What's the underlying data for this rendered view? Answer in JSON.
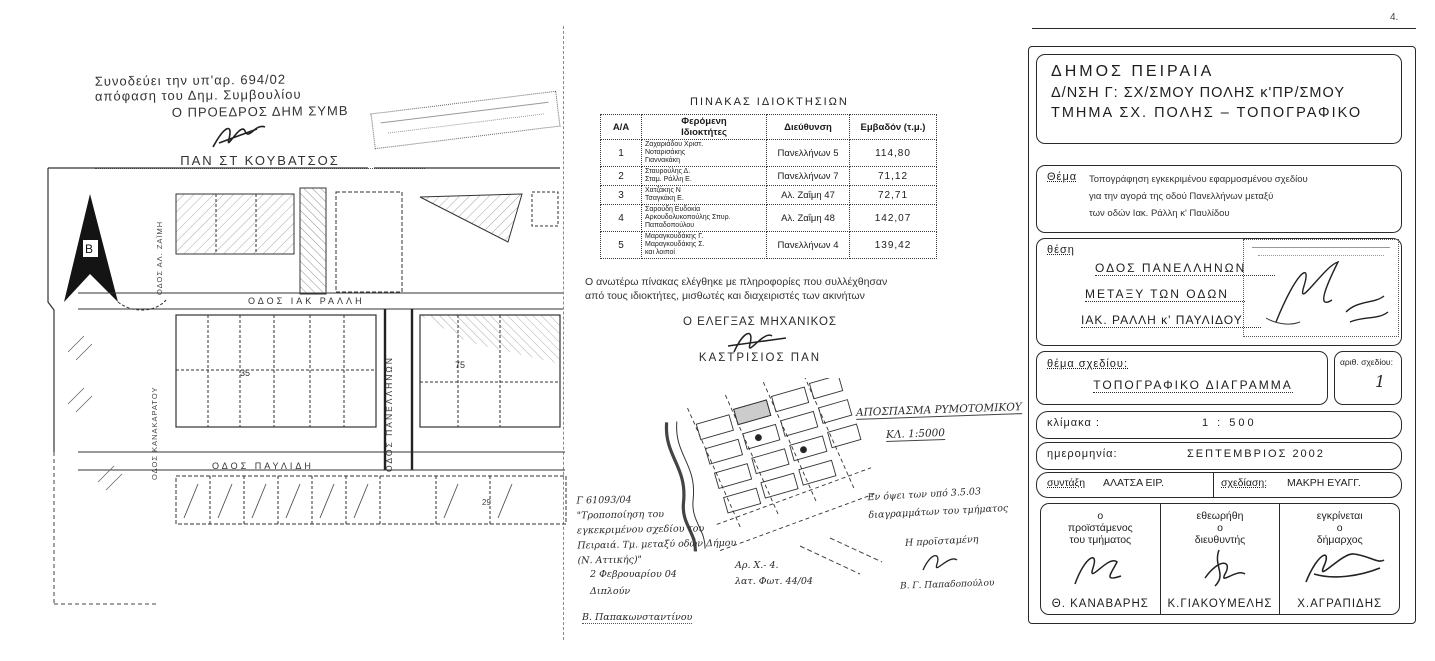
{
  "artifacts": {
    "corner_mark": "4."
  },
  "decision_stamp": {
    "line1": "Συνοδεύει  την  υπ'αρ.  694/02",
    "line2": "απόφαση  του  Δημ. Συμβουλίου",
    "line3": "Ο  ΠΡΟΕΔΡΟΣ   ΔΗΜ  ΣΥΜΒ",
    "name": "ΠΑΝ  ΣΤ  ΚΟΥΒΑΤΣΟΣ"
  },
  "plan": {
    "north_label": "Β",
    "street_ralli": "ΟΔΟΣ  ΙΑΚ  ΡΑΛΛΗ",
    "street_panellinon": "ΟΔΟΣ ΠΑΝΕΛΛΗΝΩΝ",
    "street_pavlidi": "ΟΔΟΣ ΠΑΥΛΙΔΗ",
    "street_zaimi": "ΟΔΟΣ ΑΛ. ΖΑΪΜΗ",
    "street_left": "ΟΔΟΣ ΚΑΝΑΚΑΡΑΤΟΥ",
    "lot_a": "35",
    "lot_b": "75",
    "lot_c": "29"
  },
  "ownership_table": {
    "title": "ΠΙΝΑΚΑΣ ΙΔΙΟΚΤΗΣΙΩΝ",
    "headers": {
      "index": "Α/Α",
      "owners": "Φερόμενη\nΙδιοκτήτες",
      "address": "Διεύθυνση",
      "area": "Εμβαδόν (τ.μ.)"
    },
    "rows": [
      {
        "index": "1",
        "owners": "Ζαχαριάδου Χριστ.\nΝοταρισάκης\nΓιαννακάκη",
        "address": "Πανελλήνων 5",
        "area": "114,80"
      },
      {
        "index": "2",
        "owners": "Σταυρούλης Δ.\nΣταμ. Ράλλη Ε.",
        "address": "Πανελλήνων 7",
        "area": "71,12"
      },
      {
        "index": "3",
        "owners": "Χατζάκης Ν\nΤσαγκάκη Ε.",
        "address": "Αλ. Ζαΐμη 47",
        "area": "72,71"
      },
      {
        "index": "4",
        "owners": "Σαρούδη Ευδοκία\nΑρκουδολυκοπούλης Σπυρ.\nΠαπαδοπούλου",
        "address": "Αλ. Ζαΐμη 48",
        "area": "142,07"
      },
      {
        "index": "5",
        "owners": "Μαραγκουδάκης Γ.\nΜαραγκουδάκης Σ.\nκαι λοιποί",
        "address": "Πανελλήνων 4",
        "area": "139,42"
      }
    ],
    "footnote": "Ο ανωτέρω πίνακας ελέγθηκε με πληροφορίες που συλλέχθησαν\nαπό τους ιδιοκτήτες, μισθωτές και διαχειριστές των ακινήτων"
  },
  "engineer": {
    "title": "Ο ΕΛΕΓΞΑΣ ΜΗΧΑΝΙΚΟΣ",
    "name": "ΚΑΣΤΡΙΣΙΟΣ ΠΑΝ"
  },
  "excerpt_map": {
    "caption": "ΑΠΟΣΠΑΣΜΑ ΡΥΜΟΤΟΜΙΚΟΥ",
    "scale": "ΚΛ. 1:5000"
  },
  "handwritten": {
    "left_note": "Γ 61093/04\n\"Τροποποίηση του\nεγκεκριμένου σχεδίου του\nΠειραιά. Τμ. μεταξύ οδών Δήμου\n(Ν. Αττικής)\"",
    "left_date": "2 Φεβρουαρίου 04\nΔιπλούν",
    "left_name": "Β. Παπακωνσταντίνου",
    "center_note": "Αρ. Χ.-  4.\nλατ. Φωτ.  44/04",
    "right_note": "Εν όψει των υπό 3.5.03\nδιαγραμμάτων του τμήματος",
    "right_role": "Η προϊσταμένη",
    "right_name": "Β. Γ. Παπαδοπούλου"
  },
  "titleblock": {
    "header_line1": "ΔΗΜΟΣ  ΠΕΙΡΑΙΑ",
    "header_line2": "Δ/ΝΣΗ  Γ: ΣΧ/ΣΜΟΥ  ΠΟΛΗΣ κ'ΠΡ/ΣΜΟΥ",
    "header_line3": "ΤΜΗΜΑ ΣΧ. ΠΟΛΗΣ – ΤΟΠΟΓΡΑΦΙΚΟ",
    "thema_label": "Θέμα",
    "thema_text": "Τοπογράφηση εγκεκριμένου εφαρμοσμένου σχεδίου\nγια την  αγορά  της οδού Πανελλήνων μεταξύ\nτων οδών  Ιακ. Ράλλη  κ'  Παυλίδου",
    "thesi_label": "θέση",
    "thesi_line1": "ΟΔΟΣ   ΠΑΝΕΛΛΗΝΩΝ",
    "thesi_line2": "ΜΕΤΑΞΥ  ΤΩΝ  ΟΔΩΝ",
    "thesi_line3": "ΙΑΚ. ΡΑΛΛΗ  κ'  ΠΑΥΛΙΔΟΥ",
    "drawing_label": "θέμα σχεδίου:",
    "drawing_value": "ΤΟΠΟΓΡΑΦΙΚΟ   ΔΙΑΓΡΑΜΜΑ",
    "drawing_no_label": "αριθ. σχεδίου:",
    "drawing_no_value": "1",
    "scale_label": "κλίμακα :",
    "scale_value": "1 : 500",
    "date_label": "ημερομηνία:",
    "date_value": "ΣΕΠΤΕΜΒΡΙΟΣ   2002",
    "author_label": "συντάξη",
    "author_value": "ΑΛΑΤΣΑ   ΕΙΡ.",
    "draft_label": "σχεδίαση:",
    "draft_value": "ΜΑΚΡΗ   ΕΥΑΓΓ.",
    "approvals": [
      {
        "role": "ο\nπροϊστάμενος\nτου τμήματος",
        "name": "Θ. ΚΑΝΑΒΑΡΗΣ"
      },
      {
        "role": "εθεωρήθη\nο\nδιευθυντής",
        "name": "Κ.ΓΙΑΚΟΥΜΕΛΗΣ"
      },
      {
        "role": "εγκρίνεται\nο\nδήμαρχος",
        "name": "Χ.ΑΓΡΑΠΙΔΗΣ"
      }
    ]
  }
}
